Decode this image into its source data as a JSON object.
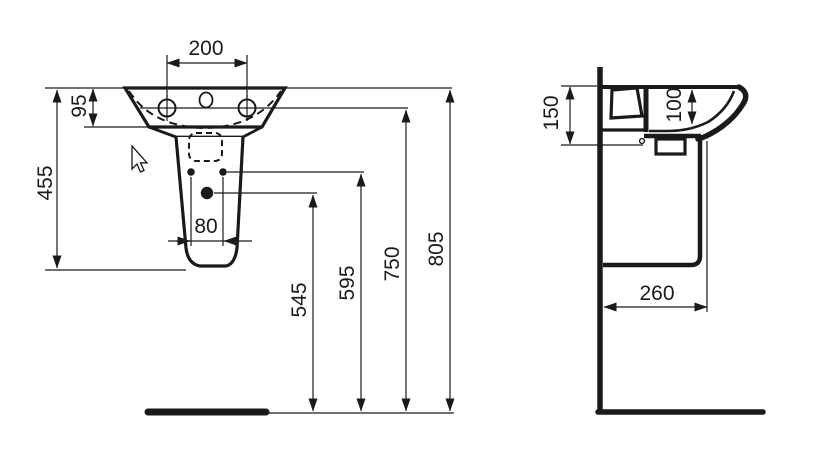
{
  "drawing": {
    "background_color": "#ffffff",
    "line_color": "#1a1a1a",
    "front_view": {
      "dims": {
        "tap_hole_spacing": "200",
        "rim_to_basin_underside": "95",
        "rim_to_pedestal_bottom": "455",
        "fixing_hole_spacing": "80",
        "floor_to_waste_outlet": "545",
        "floor_to_fixing_holes": "595",
        "floor_to_tap_centerline": "750",
        "floor_to_rim": "805"
      }
    },
    "side_view": {
      "dims": {
        "front_fixing_height": "150",
        "bowl_depth": "100",
        "wall_to_pedestal_front": "260"
      }
    }
  }
}
